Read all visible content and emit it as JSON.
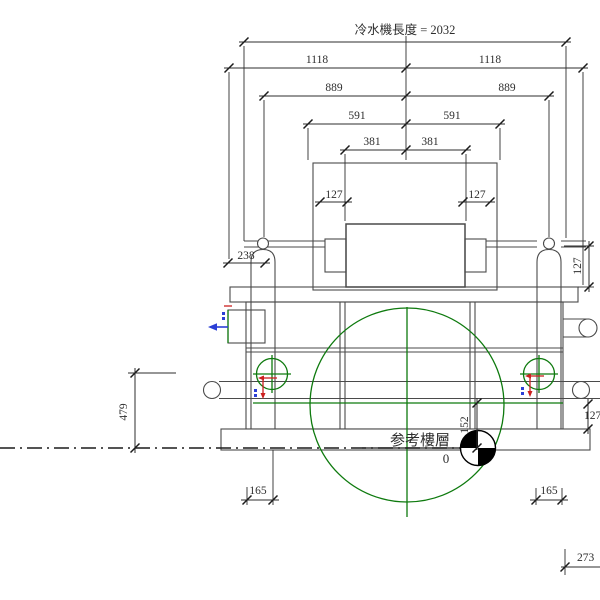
{
  "drawing": {
    "title": "冷水機長度 = 2032",
    "ref_level_label": "参考樓層",
    "ref_level_value": "0",
    "dims": {
      "half_left": "1118",
      "half_right": "1118",
      "d889_left": "889",
      "d889_right": "889",
      "d591_left": "591",
      "d591_right": "591",
      "d381_left": "381",
      "d381_right": "381",
      "d127_top_left": "127",
      "d127_top_right": "127",
      "d238": "238",
      "d479": "479",
      "d152": "152",
      "d127_right_upper": "127",
      "d127_right_lower": "127",
      "d165_left": "165",
      "d165_right": "165",
      "d273": "273"
    },
    "colors": {
      "machine_line": "#4a4a4a",
      "dimension_line": "#2e2e2e",
      "centerline_green": "#0e7a0e",
      "marker_red": "#cc1f1f",
      "marker_blue": "#2b3fd6",
      "level_symbol_black": "#000000"
    }
  }
}
